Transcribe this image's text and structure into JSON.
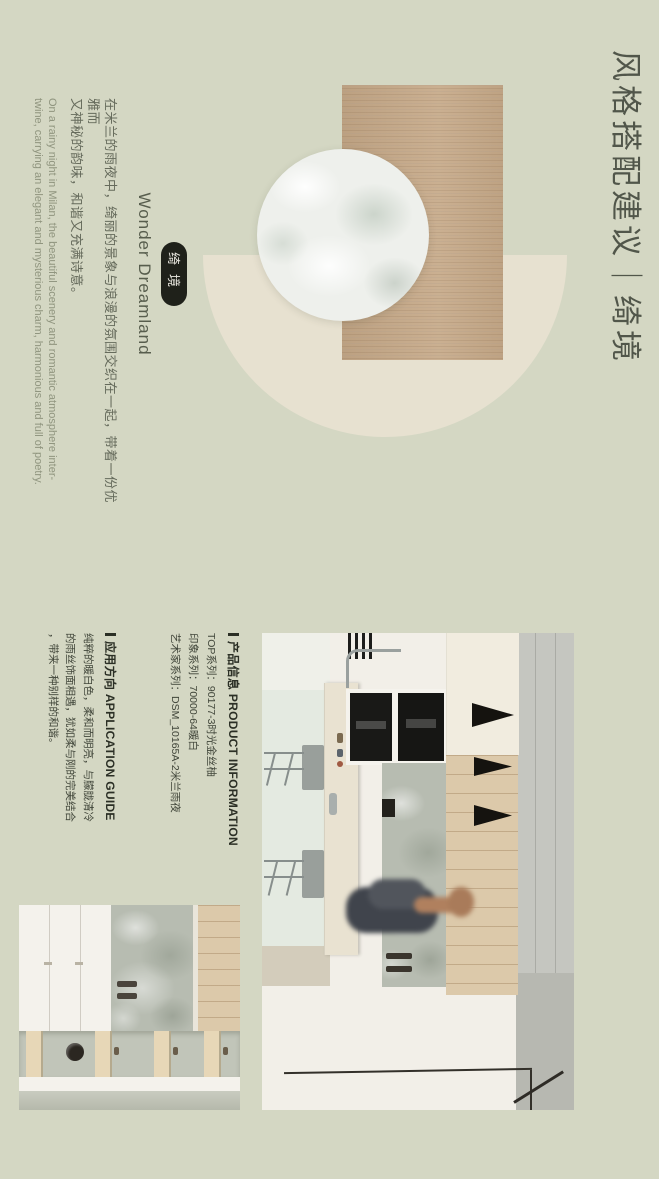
{
  "header": {
    "title": "风格搭配建议｜绮境"
  },
  "intro": {
    "badge": "绮境",
    "heading": "Wonder Dreamland",
    "zh_lines": [
      "在米兰的雨夜中，绮丽的景象与浪漫的氛围交织在一起，带着一份优雅而",
      "又神秘的韵味，和谐又充满诗意。"
    ],
    "en_lines": [
      "On a rainy night in Milan, the beautiful scenery and romantic atmosphere inter-",
      "twine, carrying an elegant and mysterious charm, harmonious and full of poetry."
    ]
  },
  "product_info": {
    "title_zh": "产品信息",
    "title_en": "PRODUCT INFORMATION",
    "rows": [
      {
        "text": "TOP系列：90177-3时光金丝柚"
      },
      {
        "text": "印象系列：70000-64暖白"
      },
      {
        "text": "艺术家系列：DSM_10165A-2米兰雨夜"
      }
    ]
  },
  "application_guide": {
    "title_zh": "应用方向",
    "title_en": "APPLICATION GUIDE",
    "lines": [
      "纯粹的暖白色，柔和而明亮，与朦胧清冷",
      "的雨丝饰面相遇，犹如柔与刚的完美结合",
      "，带来一种别样的和谐。"
    ]
  },
  "colors": {
    "page_bg": "#d4d7c3",
    "title_text": "#51564a",
    "badge_bg": "#1f211a",
    "semicircle": "#e7e1d0",
    "wood_swatch": "#c6a988",
    "pearl_swatch": "#eef0ec",
    "body_text": "#666b5c",
    "spec_text": "#41463a"
  }
}
